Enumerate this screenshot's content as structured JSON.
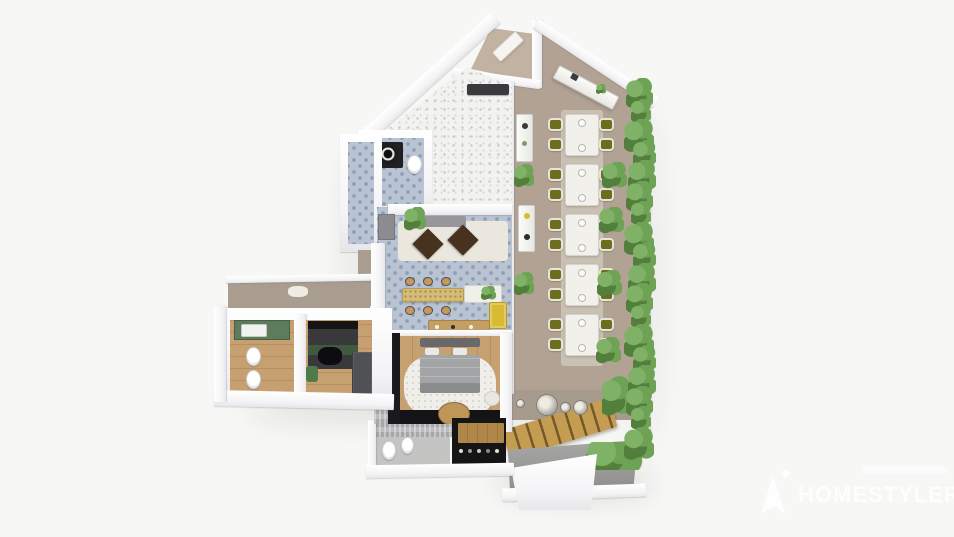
{
  "watermark": {
    "brand": "HOMESTYLER",
    "logo_icon": "homestyler-logo",
    "sparkle_icon": "sparkle-icon",
    "tagline_legible": false
  },
  "palette": {
    "background": "#f7f7f5",
    "hall_floor": "#b1a294",
    "hall_drop_wall": "#a69b8d",
    "carpet": "#c9c1b3",
    "vestibule": "#c1b2a2",
    "tile_blue": "#b9c3d2",
    "tile_motif": "#8ba0b7",
    "terrazzo": "#f2f2f0",
    "wood": "#c7a071",
    "wood_dark": "#b8905f",
    "stairs_wood": "#c59d52",
    "stairs_riser": "#75592a",
    "concrete_a": "#a8a8a6",
    "concrete_b": "#8d8d8b",
    "hedge_a": "#6ea254",
    "hedge_b": "#527f3c",
    "hedge_c": "#7fb267",
    "chair_olive": "#6d6e1c",
    "chair_frame": "#e6e4dc",
    "gold": "#d5bc7b",
    "yellow": "#d8ba33",
    "dark": "#1a1a1c",
    "diamond": "#46321f",
    "bed_gray": "#a3a4a6",
    "rug": "#f0eee9",
    "taupe": "#a89d8f",
    "green_vanity": "#5d7b5d"
  },
  "scene": {
    "dining_sets": 5,
    "chairs_per_set": 4,
    "right_trees": 4,
    "left_plants": 2,
    "wall_discs": 4,
    "bar_stools": 6,
    "hedge_clumps": 18,
    "rooms": [
      "main-hall",
      "entry-vestibule",
      "terrazzo-room",
      "wc",
      "side-corridor",
      "lounge",
      "bar",
      "master-bedroom",
      "master-bathroom",
      "dark-pantry",
      "left-bathroom",
      "second-bedroom",
      "entry-terrace"
    ]
  }
}
